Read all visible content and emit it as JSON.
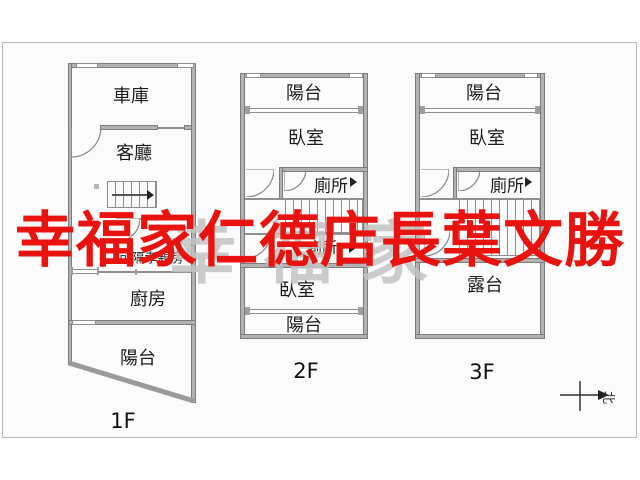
{
  "watermark": {
    "agent_text": "幸福家仁德店長葉文勝",
    "agent_color": "#e8130f",
    "brand_text": "幸福家",
    "brand_color": "#c4c3c3"
  },
  "plans": {
    "f1": {
      "floor": "1F",
      "garage": "車庫",
      "living": "客廳",
      "flex_room": "可隔孝親房",
      "kitchen": "廚房",
      "balcony": "陽台"
    },
    "f2": {
      "floor": "2F",
      "balcony_front": "陽台",
      "bedroom_front": "臥室",
      "toilet_upper": "廁所",
      "toilet_lower": "廁所",
      "bedroom_back": "臥室",
      "balcony_back": "陽台"
    },
    "f3": {
      "floor": "3F",
      "balcony": "陽台",
      "bedroom": "臥室",
      "toilet": "廁所",
      "terrace": "露台"
    }
  },
  "compass": {
    "north": "北"
  }
}
